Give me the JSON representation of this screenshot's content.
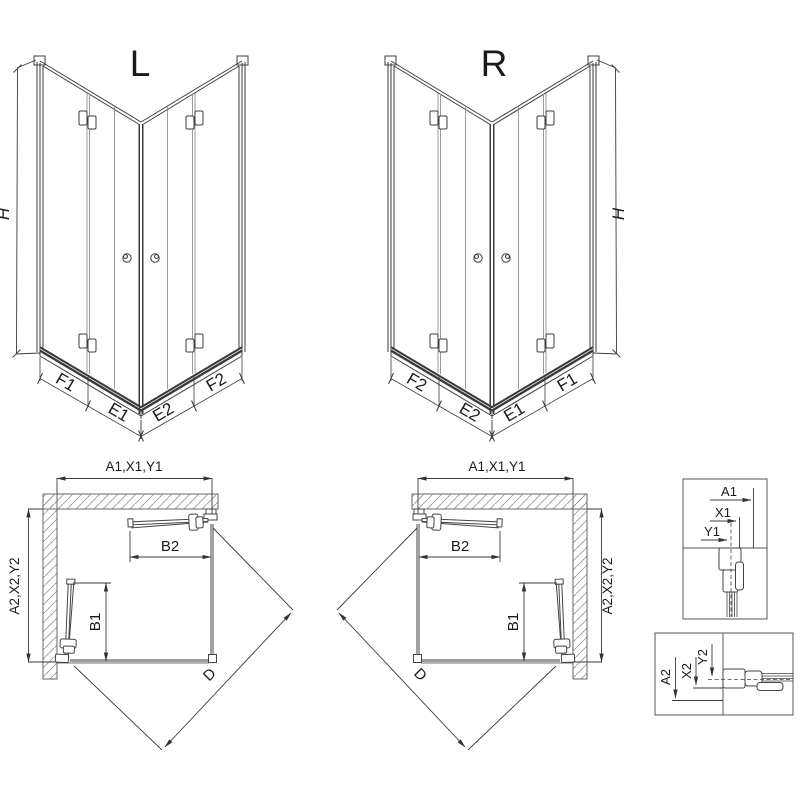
{
  "views": {
    "iso_left": {
      "label": "L",
      "height": "H",
      "segments": [
        "F1",
        "E1",
        "E2",
        "F2"
      ]
    },
    "iso_right": {
      "label": "R",
      "height": "H",
      "segments": [
        "F2",
        "E2",
        "E1",
        "F1"
      ]
    },
    "plan_left": {
      "width": "A1,X1,Y1",
      "depth": "A2,X2,Y2",
      "door_top": "B2",
      "door_side": "B1",
      "diagonal": "D"
    },
    "plan_right": {
      "width": "A1,X1,Y1",
      "depth": "A2,X2,Y2",
      "door_top": "B2",
      "door_side": "B1",
      "diagonal": "D"
    },
    "detail_top": {
      "dims": [
        "A1",
        "X1",
        "Y1"
      ]
    },
    "detail_bottom": {
      "dims": [
        "A2",
        "X2",
        "Y2"
      ]
    }
  },
  "colors": {
    "line": "#3a3a3a",
    "wall_outline": "#666666",
    "hatch": "#999999",
    "glass_gray": "#9a9a9a",
    "rail_dark": "#3a3a3a",
    "text": "#1a1a1a",
    "background": "#ffffff"
  }
}
